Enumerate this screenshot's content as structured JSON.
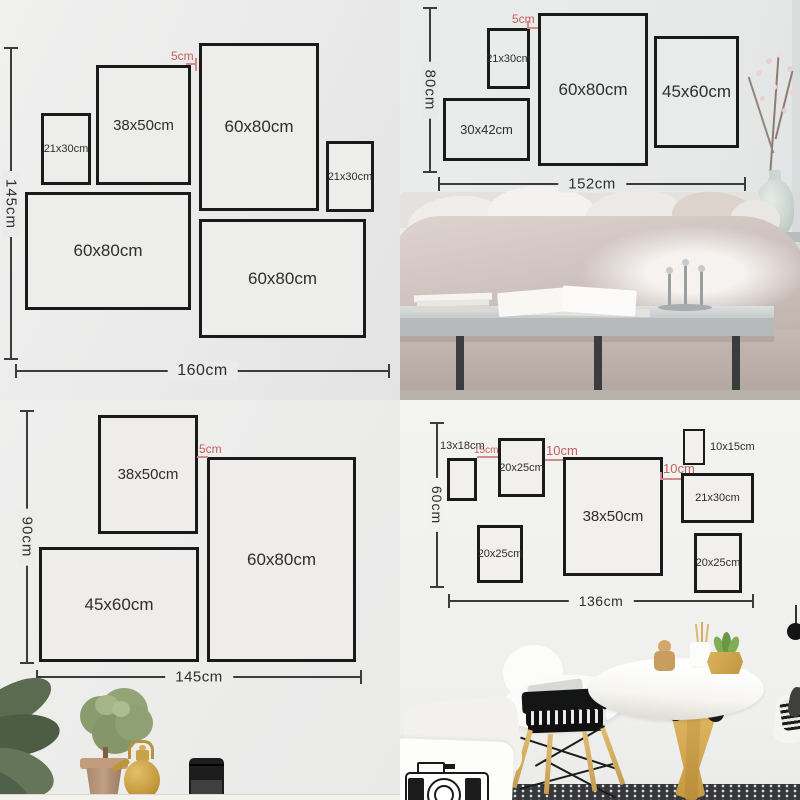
{
  "colors": {
    "frame_border": "#1a1a1a",
    "dimension_line": "#3c3c3c",
    "gap_accent_red": "#c45f5f",
    "wood_gold": "#d2a855",
    "duvet_taupe": "#cfc3bf"
  },
  "tl": {
    "total_height": "145cm",
    "total_width": "160cm",
    "gap": "5cm",
    "frames": [
      "21x30cm",
      "38x50cm",
      "60x80cm",
      "21x30cm",
      "60x80cm",
      "60x80cm"
    ]
  },
  "tr": {
    "total_height": "80cm",
    "total_width": "152cm",
    "gap": "5cm",
    "frames": [
      "21x30cm",
      "60x80cm",
      "45x60cm",
      "30x42cm"
    ]
  },
  "bl": {
    "total_height": "90cm",
    "total_width": "145cm",
    "gap": "5cm",
    "frames": [
      "38x50cm",
      "60x80cm",
      "45x60cm"
    ]
  },
  "br": {
    "total_height": "60cm",
    "total_width": "136cm",
    "gap_15": "15cm",
    "gap_10_left": "10cm",
    "gap_10_right": "10cm",
    "label_13x18": "13x18cm",
    "label_10x15": "10x15cm",
    "frames": [
      "20x25cm",
      "38x50cm",
      "21x30cm",
      "20x25cm",
      "20x25cm"
    ]
  }
}
